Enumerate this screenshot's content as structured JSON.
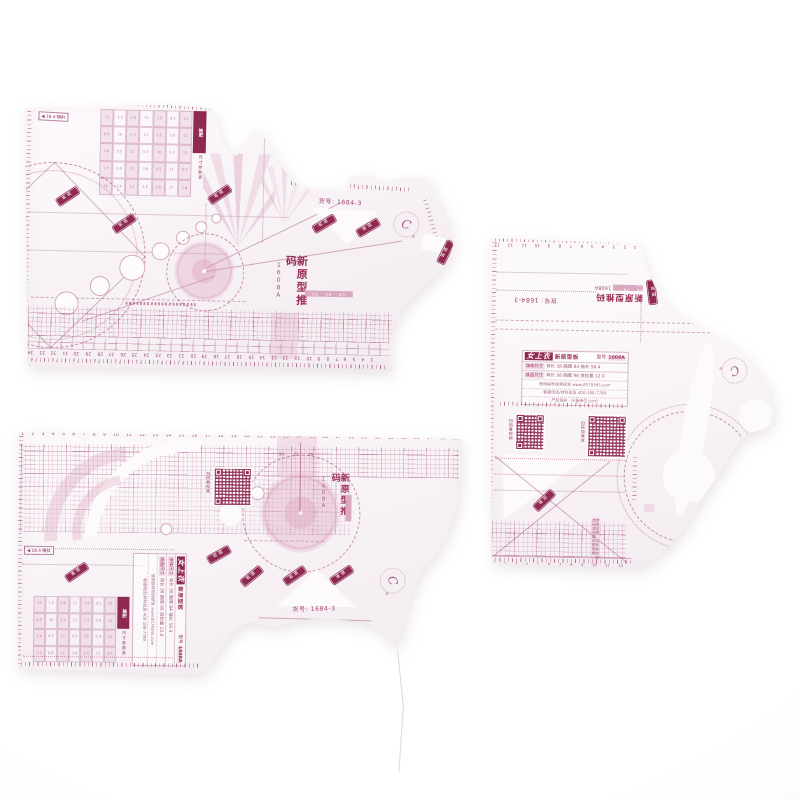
{
  "scene": {
    "type": "product-photo",
    "description": "Three translucent plastic sewing pattern grading template rulers lying on a white background",
    "background": "#ffffff",
    "ink_color": "#96325a"
  },
  "shared": {
    "item_no": "货号: 1684-3",
    "series_title": "新原型推码",
    "model": "1608A",
    "size_strip": "36 · 38 · 40",
    "brand": "女上衣",
    "subtitle": "新原型板",
    "model_label": "型号",
    "model_value": "1608A",
    "spec_row1_label": "净体尺寸",
    "spec_row1_values": "背长 38  胸围 84  袖长 56.4",
    "spec_row2_label": "成品尺寸",
    "spec_row2_values": "背长 38  胸围 96  放松量 12.0",
    "info_line1": "使用指导视频研发  www.8579345.com",
    "info_line2": "客服电话/材料批发  400-188-7789",
    "info_line3": "产权保护 · 计量单位 (cm)",
    "qr_caption_video": "扫码看视频",
    "qr_caption_wechat": "扫码加微信",
    "corner_label": "◀ 18.4·横斜",
    "param_title": "袖肥",
    "param_note": "尺寸参数表",
    "badge_text": "省道",
    "usage_note": "使用说明 对齐布纹线 放码请先固定原型板",
    "logo_text": "C",
    "logo_reg": "®"
  },
  "rulers": {
    "a_bottom": [
      34,
      33,
      32,
      31,
      30,
      29,
      28,
      27,
      26,
      25,
      24,
      23,
      22,
      21,
      20,
      19,
      18,
      17,
      16,
      15,
      14,
      13,
      12,
      11,
      10,
      9,
      8,
      7,
      6,
      5,
      4,
      3
    ],
    "b_top": [
      1,
      2,
      3,
      4,
      5,
      6,
      7,
      8,
      9,
      10,
      11,
      12,
      13,
      14,
      15,
      16,
      17,
      18,
      19,
      20,
      21,
      22,
      23,
      24,
      25,
      26,
      27,
      28,
      29,
      30,
      31,
      32,
      33,
      34,
      35,
      36
    ],
    "b_inset": [
      24,
      25,
      26
    ],
    "c_top": [
      13,
      12,
      11,
      10,
      9,
      8,
      7,
      6,
      5,
      4,
      3,
      2,
      1
    ],
    "c_bottom": [
      1,
      2,
      3,
      4,
      5,
      6,
      7,
      8,
      9,
      10,
      11,
      12
    ],
    "param_digits": [
      "13",
      "1.5",
      "0.8",
      "12",
      "3.6",
      "9.5",
      "11",
      "0.5",
      "36",
      "2.4"
    ]
  }
}
